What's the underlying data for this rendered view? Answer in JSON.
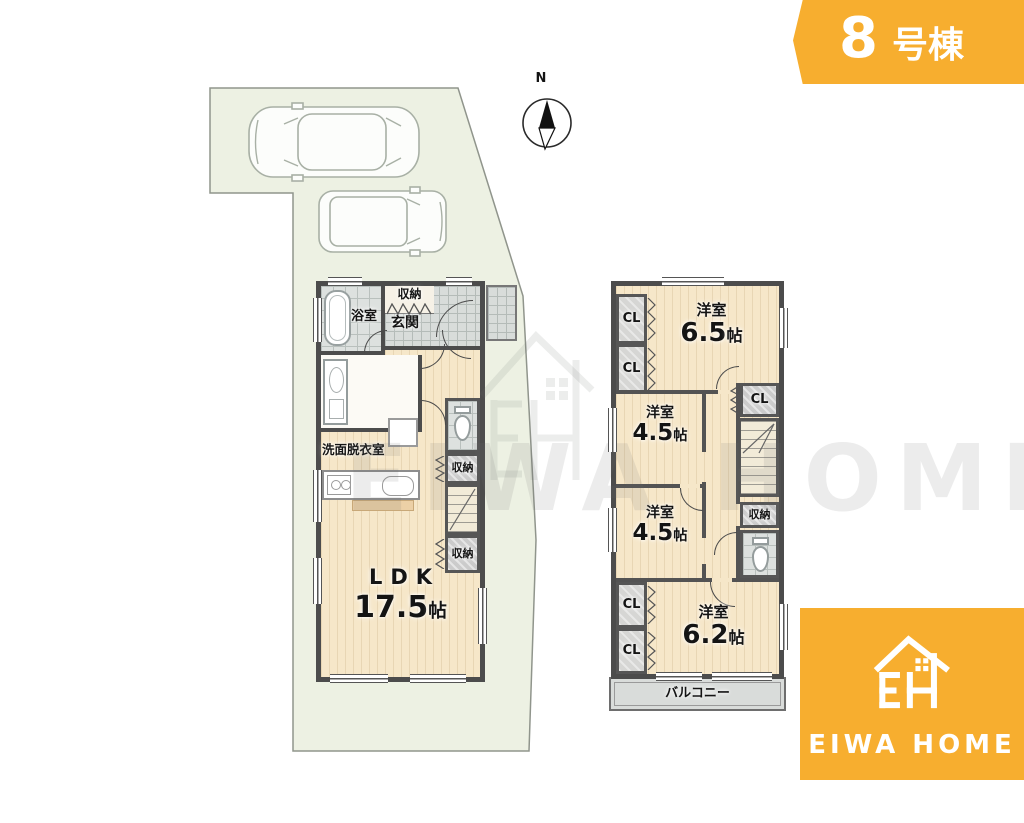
{
  "header": {
    "number": "8",
    "suffix": "号棟"
  },
  "compass": {
    "north": "N"
  },
  "floor1": {
    "bath": "浴室",
    "entry_storage": "収納",
    "entrance": "玄関",
    "washroom": "洗面脱衣室",
    "storage_mid": "収納",
    "storage_low": "収納",
    "ldk": {
      "name": "LDK",
      "size_value": "17.5",
      "size_unit": "帖"
    }
  },
  "floor2": {
    "closets": {
      "c1": "CL",
      "c2": "CL",
      "c3": "CL",
      "c4": "CL",
      "c5": "CL"
    },
    "room_top": {
      "name": "洋室",
      "size_value": "6.5",
      "size_unit": "帖"
    },
    "room_mid1": {
      "name": "洋室",
      "size_value": "4.5",
      "size_unit": "帖"
    },
    "room_mid2": {
      "name": "洋室",
      "size_value": "4.5",
      "size_unit": "帖"
    },
    "room_bottom": {
      "name": "洋室",
      "size_value": "6.2",
      "size_unit": "帖"
    },
    "storage": "収納",
    "balcony": "バルコニー"
  },
  "brand": {
    "name": "EIWA HOME"
  },
  "watermark": {
    "text": "EIWA HOME"
  },
  "colors": {
    "accent": "#F7AE2F",
    "site_fill": "#EDF1E3",
    "floor_fill": "#F6E7C9",
    "wall": "#4C4C4C"
  }
}
